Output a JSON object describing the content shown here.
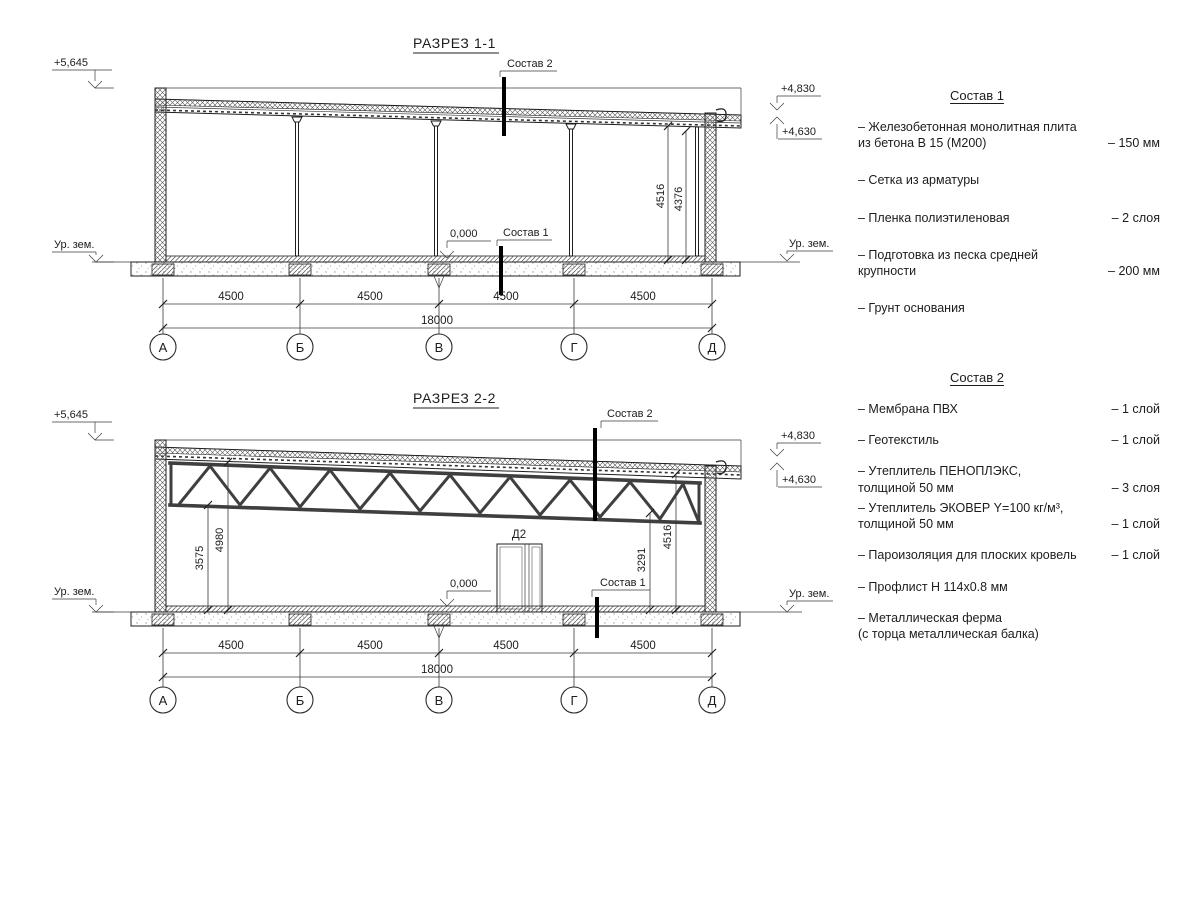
{
  "s1": {
    "title": "РАЗРЕЗ 1-1",
    "callout_top": "Состав 2",
    "callout_floor": "Состав 1",
    "level_left": "+5,645",
    "level_right_top": "+4,830",
    "level_right_bottom": "+4,630",
    "level_zero": "0,000",
    "ground_left": "Ур. зем.",
    "ground_right": "Ур. зем.",
    "height_dims": [
      "4516",
      "4376"
    ],
    "span_dims": [
      "4500",
      "4500",
      "4500",
      "4500"
    ],
    "total_dim": "18000",
    "axes": [
      "А",
      "Б",
      "В",
      "Г",
      "Д"
    ]
  },
  "s2": {
    "title": "РАЗРЕЗ 2-2",
    "callout_top": "Состав 2",
    "callout_floor": "Состав 1",
    "level_left": "+5,645",
    "level_right_top": "+4,830",
    "level_right_bottom": "+4,630",
    "level_zero": "0,000",
    "ground_left": "Ур. зем.",
    "ground_right": "Ур. зем.",
    "door_label": "Д2",
    "height_dims_left": [
      "3575",
      "4980"
    ],
    "height_dims_right": [
      "3291",
      "4516"
    ],
    "span_dims": [
      "4500",
      "4500",
      "4500",
      "4500"
    ],
    "total_dim": "18000",
    "axes": [
      "А",
      "Б",
      "В",
      "Г",
      "Д"
    ]
  },
  "c1": {
    "title": "Состав 1",
    "items": [
      {
        "name": "– Железобетонная  монолитная плита\nиз бетона В 15 (М200)",
        "value": "– 150 мм"
      },
      {
        "name": "– Сетка из арматуры",
        "value": ""
      },
      {
        "name": "– Пленка полиэтиленовая",
        "value": "– 2 слоя"
      },
      {
        "name": "– Подготовка из песка средней\nкрупности",
        "value": "– 200 мм"
      },
      {
        "name": "– Грунт основания",
        "value": ""
      }
    ]
  },
  "c2": {
    "title": "Состав 2",
    "items": [
      {
        "name": "– Мембрана ПВХ",
        "value": "– 1 слой"
      },
      {
        "name": "– Геотекстиль",
        "value": "– 1 слой"
      },
      {
        "name": "– Утеплитель ПЕНОПЛЭКС,\nтолщиной 50 мм",
        "value": "– 3 слоя"
      },
      {
        "name": "– Утеплитель ЭКОВЕР Y=100 кг/м³,\nтолщиной 50 мм",
        "value": "– 1 слой"
      },
      {
        "name": "– Пароизоляция для плоских кровель",
        "value": "– 1 слой"
      },
      {
        "name": "– Профлист Н 114х0.8 мм",
        "value": ""
      },
      {
        "name": "– Металлическая ферма\n(с торца металлическая балка)",
        "value": ""
      }
    ]
  }
}
